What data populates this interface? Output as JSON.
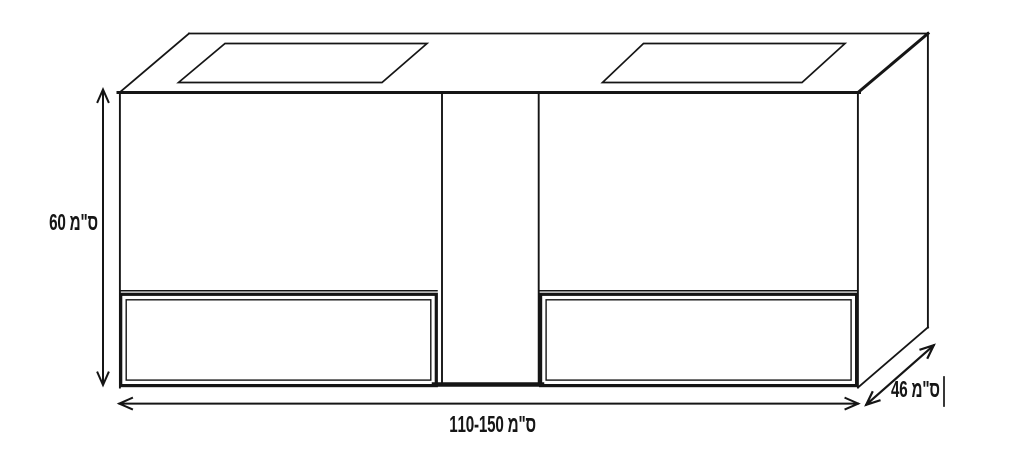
{
  "drawing": {
    "background": "#ffffff",
    "line_color": "#151515",
    "labels": {
      "height": "ס\"מ 60",
      "width": "ס\"מ 110-150",
      "depth": "ס\"מ 46"
    }
  }
}
